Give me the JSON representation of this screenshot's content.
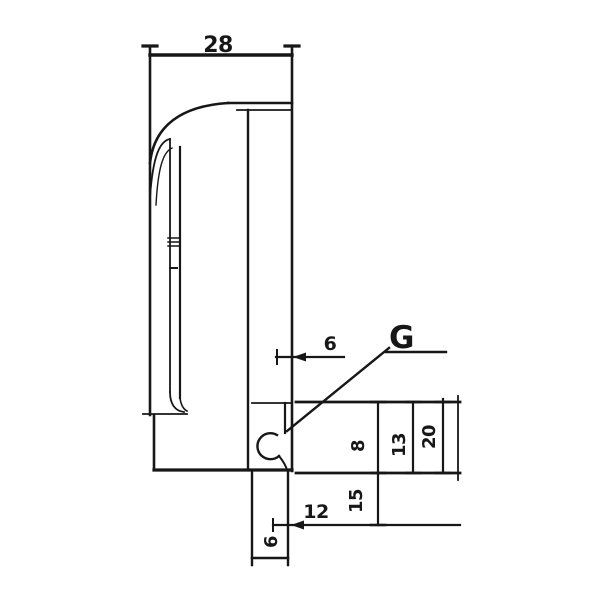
{
  "drawing": {
    "kind": "technical-dimension-drawing",
    "labels": {
      "top_width": "28",
      "edge_offset": "6",
      "reference_letter": "G",
      "bottom_offset": "12",
      "lower_height": "15",
      "depth_inner": "8",
      "depth_mid": "13",
      "depth_outer": "20",
      "foot_width": "6"
    },
    "colors": {
      "ink": "#171717",
      "background": "#ffffff"
    }
  }
}
